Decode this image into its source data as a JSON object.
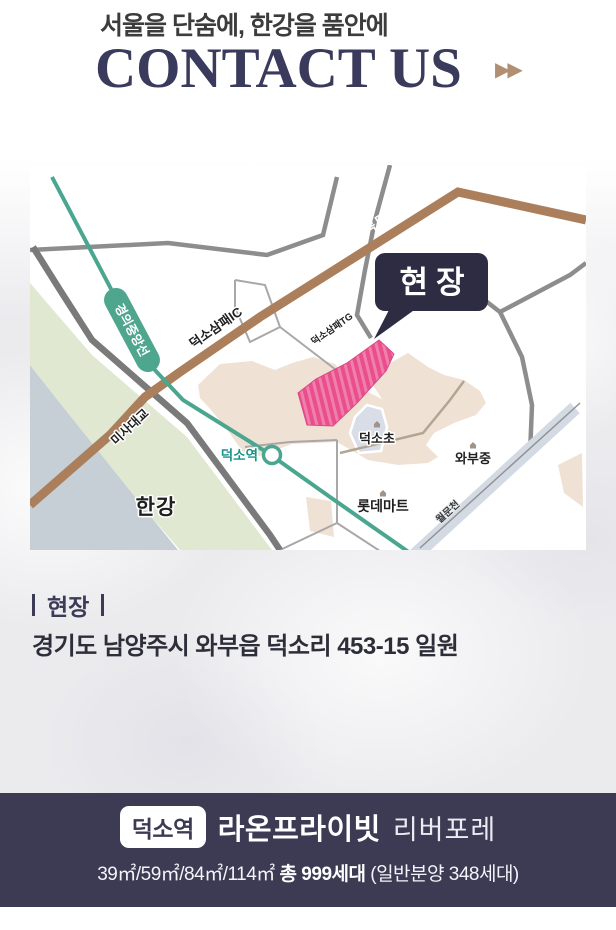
{
  "header": {
    "subtitle": "서울을 단숨에, 한강을 품안에",
    "title": "CONTACT US",
    "arrows": "▶▶"
  },
  "map": {
    "labels": {
      "highway": "서울~양양고속도로",
      "interchange": "덕소삼패IC",
      "tollgate": "덕소삼패TG",
      "rail_line": "경의중앙선",
      "bridge": "미사대교",
      "river": "한강",
      "station": "덕소역",
      "callout": "현장",
      "school_elementary": "덕소초",
      "school_middle": "와부중",
      "mart": "롯데마트",
      "stream": "월문천"
    },
    "colors": {
      "highway_brown": "#ab7f5c",
      "rail_green": "#4aa68f",
      "water_blue": "#c6cfd6",
      "shore_green": "#e0e8d2",
      "urban_beige": "#efe2d5",
      "site_pink": "#ec5a92",
      "callout_navy": "#2d2c43",
      "road_gray": "#8d8d8d"
    }
  },
  "location": {
    "marker_title": "현장",
    "address": "경기도 남양주시 와부읍 덕소리 453-15 일원"
  },
  "footer": {
    "station_badge": "덕소역",
    "brand": "라온프라이빗",
    "sub_brand": "리버포레",
    "area_sizes": "39㎡/59㎡/84㎡/114㎡",
    "total_units": "총 999세대",
    "note": "(일반분양 348세대)",
    "background": "#3d3b53"
  }
}
